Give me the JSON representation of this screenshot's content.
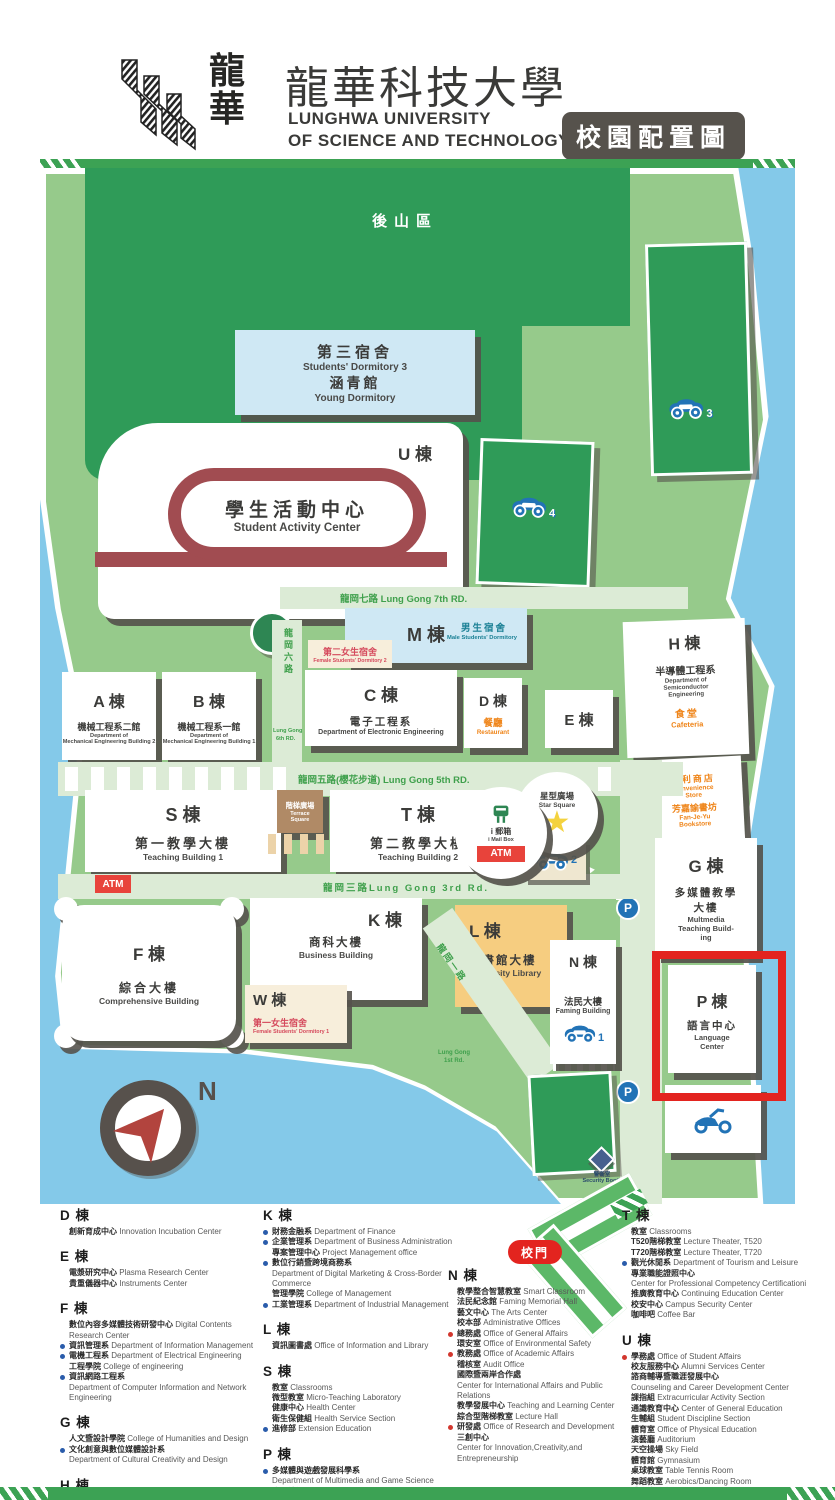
{
  "header": {
    "logo_zh1": "龍",
    "logo_zh2": "華",
    "title_zh": "龍華科技大學",
    "sub1": "LUNGHWA UNIVERSITY",
    "sub2": "OF SCIENCE AND TECHNOLOGY",
    "badge": "校園配置圖"
  },
  "map": {
    "back_mountain": "後山區",
    "compass_n": "N",
    "buildings": {
      "dorm3": {
        "zh": "第三宿舍",
        "en": "Students' Dormitory 3",
        "zh2": "涵青館",
        "en2": "Young Dormitory"
      },
      "u": {
        "code": "U 棟",
        "zh": "學生活動中心",
        "en": "Student Activity Center"
      },
      "m": {
        "code": "M 棟",
        "male_zh": "男生宿舍",
        "male_en": "Male Students' Dormitory",
        "f2_zh": "第二女生宿舍",
        "f2_en": "Female Students' Dormitory 2"
      },
      "a": {
        "code": "A 棟",
        "zh": "機械工程系二館",
        "en1": "Department of",
        "en2": "Mechanical Engineering Building 2"
      },
      "b": {
        "code": "B 棟",
        "zh": "機械工程系一館",
        "en1": "Department of",
        "en2": "Mechanical Engineering Building 1"
      },
      "c": {
        "code": "C 棟",
        "zh": "電子工程系",
        "en": "Department of Electronic Engineering"
      },
      "d": {
        "code": "D 棟",
        "zh": "餐廳",
        "en": "Restaurant"
      },
      "e": {
        "code": "E 棟"
      },
      "h": {
        "code": "H 棟",
        "zh": "半導體工程系",
        "en1": "Department of",
        "en2": "Semiconductor",
        "en3": "Engineering",
        "zh2": "食堂",
        "en4": "Cafeteria"
      },
      "store": {
        "zh1": "便利商店",
        "en1": "Convenience",
        "en1b": "Store",
        "zh2": "芳嘉諭書坊",
        "en2": "Fan-Je-Yu",
        "en2b": "Bookstore"
      },
      "s": {
        "code": "S 棟",
        "zh": "第一教學大樓",
        "en": "Teaching Building 1"
      },
      "terrace": {
        "zh": "階梯廣場",
        "en1": "Terrace",
        "en2": "Square"
      },
      "t": {
        "code": "T 棟",
        "zh": "第二教學大樓",
        "en": "Teaching Building 2"
      },
      "mail": {
        "zh": "i 郵箱",
        "en": "i Mail Box",
        "atm": "ATM"
      },
      "star": {
        "zh": "星型廣場",
        "en": "Star Square",
        "glyph": "★"
      },
      "f": {
        "code": "F 棟",
        "zh": "綜合大樓",
        "en": "Comprehensive Building"
      },
      "k": {
        "code": "K 棟",
        "zh": "商科大樓",
        "en": "Business Building"
      },
      "w": {
        "code": "W 棟",
        "zh": "第一女生宿舍",
        "en": "Female Students' Dormitory 1"
      },
      "l": {
        "code": "L 棟",
        "zh": "圖書館大樓",
        "en": "University Library"
      },
      "n": {
        "code": "N 棟",
        "zh": "法民大樓",
        "en": "Faming Building"
      },
      "g": {
        "code": "G 棟",
        "zh1": "多媒體教學",
        "zh2": "大樓",
        "en1": "Multmedia",
        "en2": "Teaching Build-",
        "en3": "ing"
      },
      "p": {
        "code": "P 棟",
        "zh": "語言中心",
        "en1": "Language",
        "en2": "Center"
      },
      "security": {
        "zh": "警衛室",
        "en": "Security Booth"
      }
    },
    "roads": {
      "r7": "龍岡七路 Lung Gong 7th RD.",
      "r6zh": "龍岡六路",
      "r6en1": "Lung Gong",
      "r6en2": "6th RD.",
      "r5": "龍岡五路(櫻花步道) Lung Gong 5th RD.",
      "r3": "龍岡三路Lung Gong 3rd Rd.",
      "r1zh": "龍岡一路",
      "r1en1": "Lung Gong",
      "r1en2": "1st Rd.",
      "atm": "ATM",
      "gate": "校門"
    },
    "parking": {
      "p": "P",
      "n1": "1",
      "n2": "2",
      "n3": "3",
      "n4": "4"
    }
  },
  "legend": {
    "columns": [
      [
        {
          "heading": "D 棟",
          "items": [
            {
              "zh": "創新育成中心",
              "en": "Innovation Incubation Center"
            }
          ]
        },
        {
          "heading": "E 棟",
          "items": [
            {
              "zh": "電漿研究中心",
              "en": "Plasma Research Center"
            },
            {
              "zh": "貴重儀器中心",
              "en": "Instruments Center"
            }
          ]
        },
        {
          "heading": "F 棟",
          "items": [
            {
              "zh": "數位內容多媒體技術研發中心",
              "en": "Digital Contents Research Center"
            },
            {
              "b": "blue",
              "zh": "資訊管理系",
              "en": "Department of Information Management"
            },
            {
              "b": "blue",
              "zh": "電機工程系",
              "en": "Department of Electrical Engineering"
            },
            {
              "zh": "工程學院",
              "en": "College of engineering"
            },
            {
              "b": "blue",
              "zh": "資訊網路工程系"
            },
            {
              "en": "Department of Computer Information and Network Engineering"
            }
          ]
        },
        {
          "heading": "G 棟",
          "items": [
            {
              "zh": "人文暨設計學院",
              "en": "College of Humanities and Design"
            },
            {
              "b": "blue",
              "zh": "文化創意與數位媒體設計系"
            },
            {
              "en": "Department of Cultural Creativity and Design"
            }
          ]
        },
        {
          "heading": "H 棟",
          "items": [
            {
              "zh": "微奈米研發中心",
              "en": "Nano Technical Research Center"
            },
            {
              "zh": "半導體工程系",
              "en": "Department of Semiconductor Engineering"
            }
          ]
        }
      ],
      [
        {
          "heading": "K 棟",
          "items": [
            {
              "b": "blue",
              "zh": "財務金融系",
              "en": "Department of Finance"
            },
            {
              "b": "blue",
              "zh": "企業管理系",
              "en": "Department of Business Administration"
            },
            {
              "zh": "專案管理中心",
              "en": "Project Management office"
            },
            {
              "b": "blue",
              "zh": "數位行銷暨跨境商務系"
            },
            {
              "en": "Department of Digital Marketing & Cross-Border Commerce"
            },
            {
              "zh": "管理學院",
              "en": "College of Management"
            },
            {
              "b": "blue",
              "zh": "工業管理系",
              "en": "Department of Industrial Management"
            }
          ]
        },
        {
          "heading": "L 棟",
          "items": [
            {
              "zh": "資訊圖書處",
              "en": "Office of Information and Library"
            }
          ]
        },
        {
          "heading": "S 棟",
          "items": [
            {
              "zh": "教室",
              "en": "Classrooms"
            },
            {
              "zh": "微型教室",
              "en": "Micro-Teaching Laboratory"
            },
            {
              "zh": "健康中心",
              "en": "Health Center"
            },
            {
              "zh": "衛生保健組",
              "en": "Health Service Section"
            },
            {
              "b": "blue",
              "zh": "進修部",
              "en": "Extension Education"
            }
          ]
        },
        {
          "heading": "P 棟",
          "items": [
            {
              "b": "blue",
              "zh": "多媒體與遊戲發展科學系"
            },
            {
              "en": "Department of Multimedia and Game Science"
            },
            {
              "b": "blue",
              "zh": "應用外語系",
              "en": "Department of Applied Foreign Languages"
            }
          ]
        }
      ],
      [
        {
          "heading": "N 棟",
          "items": [
            {
              "zh": "教學整合智慧教室",
              "en": "Smart Classroom"
            },
            {
              "zh": "法民紀念館",
              "en": "Faming  Memorial Hall"
            },
            {
              "zh": "藝文中心",
              "en": "The Arts Center"
            },
            {
              "zh": "校本部",
              "en": "Administrative Offices"
            },
            {
              "b": "red",
              "zh": "總務處",
              "en": "Office of General Affairs"
            },
            {
              "zh": "環安室",
              "en": "Office of  Environmental Safety"
            },
            {
              "b": "red",
              "zh": "教務處",
              "en": "Office of Academic Affairs"
            },
            {
              "zh": "稽核室",
              "en": "Audit Office"
            },
            {
              "zh": "國際暨兩岸合作處"
            },
            {
              "en": "Center for International Affairs and Public Relations"
            },
            {
              "zh": "教學發展中心",
              "en": "Teaching and Learning Center"
            },
            {
              "zh": "綜合型階梯教室",
              "en": "Lecture Hall"
            },
            {
              "b": "red",
              "zh": "研發處",
              "en": "Office of Research and Development"
            },
            {
              "zh": "三創中心"
            },
            {
              "en": "Center for Innovation,Creativity,and Entrepreneurship"
            }
          ]
        }
      ],
      [
        {
          "heading": "T 棟",
          "items": [
            {
              "zh": "教室",
              "en": "Classrooms"
            },
            {
              "zh": "T520階梯教室",
              "en": "Lecture Theater, T520"
            },
            {
              "zh": "T720階梯教室",
              "en": "Lecture Theater, T720"
            },
            {
              "b": "blue",
              "zh": "觀光休閒系",
              "en": "Department of Tourism and Leisure"
            },
            {
              "zh": "專業職能證照中心"
            },
            {
              "en": "Center for Professional Competency Certificationi"
            },
            {
              "zh": "推廣教育中心",
              "en": "Continuing Education Center"
            },
            {
              "zh": "校安中心",
              "en": "Campus Security Center"
            },
            {
              "zh": "咖啡吧",
              "en": "Coffee Bar"
            }
          ]
        },
        {
          "heading": "U 棟",
          "items": [
            {
              "b": "red",
              "zh": "學務處",
              "en": "Office of Student Affairs"
            },
            {
              "zh": "校友服務中心",
              "en": "Alumni Services Center"
            },
            {
              "zh": "諮商輔導暨職涯發展中心"
            },
            {
              "en": "Counseling and Career Development Center"
            },
            {
              "zh": "課指組",
              "en": "Extracurricular Activity Section"
            },
            {
              "zh": "通識教育中心",
              "en": "Center of General Education"
            },
            {
              "zh": "生輔組",
              "en": "Student Discipline Section"
            },
            {
              "zh": "體育室",
              "en": "Office of Physical Education"
            },
            {
              "zh": "演藝廳",
              "en": "Auditorium"
            },
            {
              "zh": "天空操場",
              "en": "Sky Field"
            },
            {
              "zh": "體育館",
              "en": "Gymnasium"
            },
            {
              "zh": "桌球教室",
              "en": "Table Tennis Room"
            },
            {
              "zh": "舞蹈教室",
              "en": "Aerobics/Dancing Room"
            },
            {
              "zh": "體適能教室",
              "en": "Physical Fitness Room"
            },
            {
              "zh": "防身術教室",
              "en": "Self Defense Room"
            }
          ]
        }
      ]
    ]
  }
}
